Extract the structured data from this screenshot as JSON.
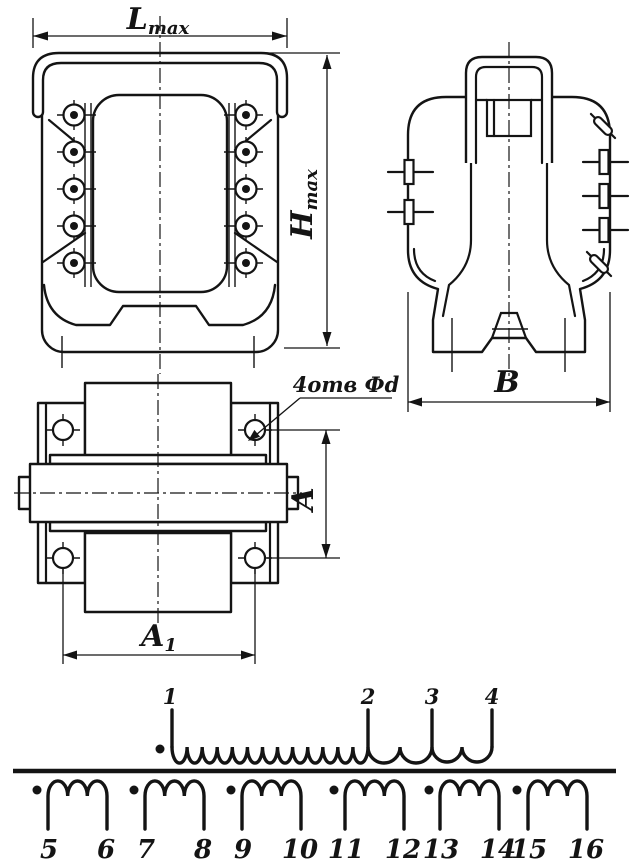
{
  "labels": {
    "l_max": {
      "base": "L",
      "sub": "max"
    },
    "h_max": {
      "base": "H",
      "sub": "max"
    },
    "b": "В",
    "a": "A",
    "a1": {
      "base": "A",
      "sub": "1"
    },
    "holes_note": "4отв Фd"
  },
  "schematic": {
    "primary": {
      "terminals": [
        "1",
        "2",
        "3",
        "4"
      ]
    },
    "secondaries": [
      {
        "left": "5",
        "right": "6"
      },
      {
        "left": "7",
        "right": "8"
      },
      {
        "left": "9",
        "right": "10"
      },
      {
        "left": "11",
        "right": "12"
      },
      {
        "left": "13",
        "right": "14"
      },
      {
        "left": "15",
        "right": "16"
      }
    ]
  },
  "colors": {
    "ink": "#141414",
    "background": "#ffffff"
  }
}
